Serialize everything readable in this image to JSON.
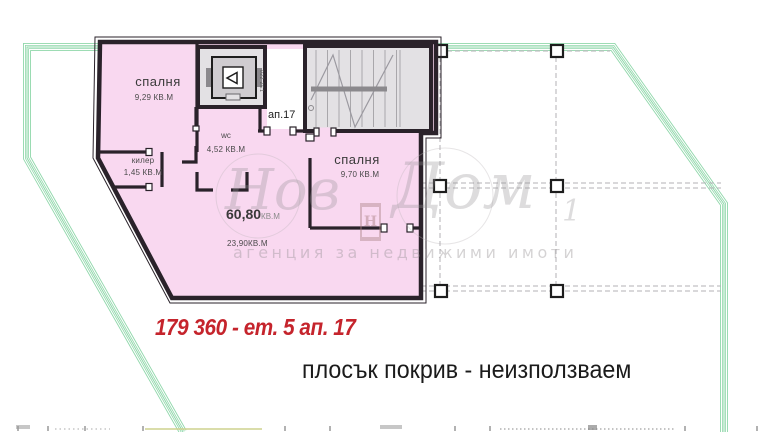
{
  "document": {
    "type": "apartment-floor-plan"
  },
  "colors": {
    "room_fill": "#f9d8f0",
    "wall": "#2a222a",
    "stair_fill": "#e3e1e4",
    "boundary_green": "#8fd7aa",
    "dashed_gray": "#b3b1b5",
    "price_red": "#c5242c",
    "text_dark": "#1b1b1b",
    "watermark_gray": "#c8c4c6"
  },
  "plan": {
    "apartment_label": "ап.17",
    "elevator_note": "022 ZE1",
    "rooms": {
      "bedroom1": {
        "name": "спалня",
        "area": "9,29 КВ.М"
      },
      "closet": {
        "name": "килер",
        "area": "1,45 КВ.М"
      },
      "wc": {
        "name": "wc",
        "area": "4,52 КВ.М"
      },
      "bedroom2": {
        "name": "спалня",
        "area": "9,70 КВ.М"
      },
      "living": {
        "total_value": "60,80",
        "total_unit": "КВ.М",
        "net_area": "23,90КВ.М"
      }
    }
  },
  "annotations": {
    "price_line": "179 360  - ет. 5 ап. 17",
    "roof_note": "плосък покрив - неизползваем"
  },
  "watermark": {
    "brand_first": "Нов",
    "brand_second": "Дом",
    "brand_suffix": "1",
    "logo_letter": "Н",
    "tagline": "агенция за недвижими имоти"
  }
}
